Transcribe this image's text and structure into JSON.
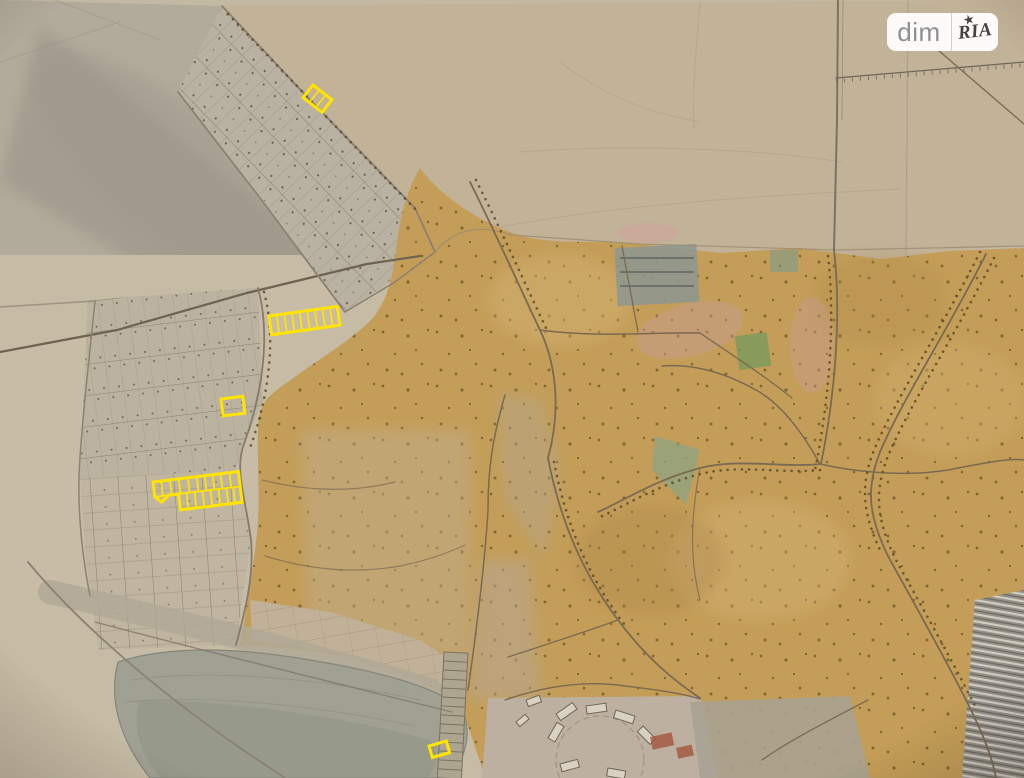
{
  "watermark": {
    "left_label": "dim",
    "right_label": "RIA",
    "star_glyph": "★"
  },
  "colors": {
    "highlight_yellow": "#FFE400",
    "paper_beige": "#c6bba4",
    "paper_gray": "#b2ab9c",
    "field_beige": "#c2b298",
    "urban_tan": "#c49e58",
    "lake_gray": "#9fa093",
    "road_brown": "#7a6a51",
    "watermark_text_gray": "#8f8e93",
    "watermark_stamp_dark": "#45433f"
  },
  "highlights": {
    "count": 5,
    "items": [
      {
        "id": "plot-a",
        "label": "small plot in upper parcel grid",
        "cells": 3
      },
      {
        "id": "plot-b",
        "label": "strip of plots",
        "cells": 9
      },
      {
        "id": "plot-c",
        "label": "single plot",
        "cells": 1
      },
      {
        "id": "plot-d",
        "label": "double-row block of plots",
        "cells": 18
      },
      {
        "id": "plot-e",
        "label": "small plot near bottom",
        "cells": 1
      }
    ]
  }
}
